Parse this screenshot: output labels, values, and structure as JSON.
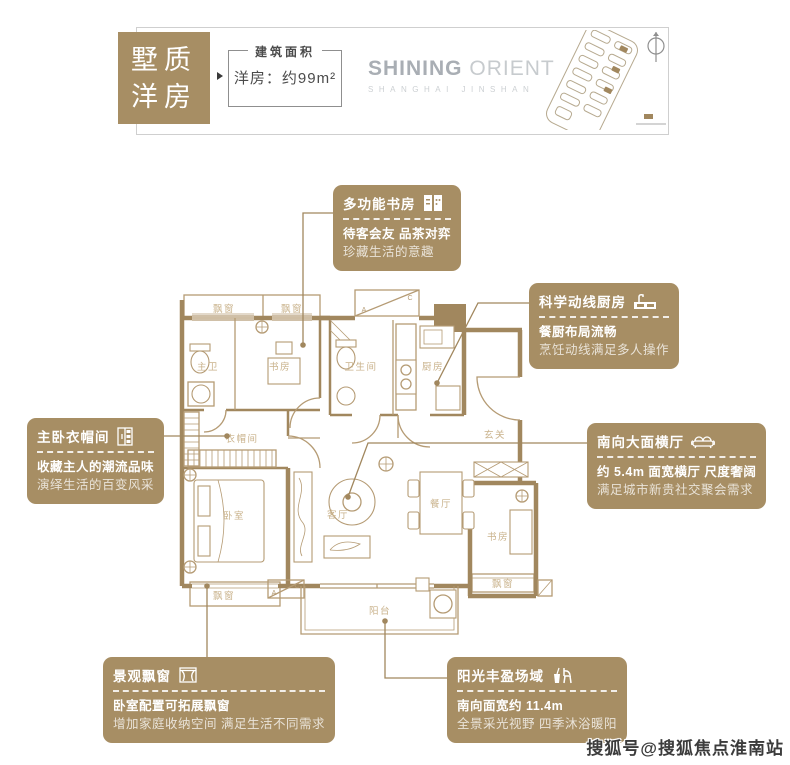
{
  "header": {
    "badge": {
      "line1": "墅质",
      "line2": "洋房"
    },
    "area_box": {
      "label": "建筑面积",
      "value": "洋房：约99m²"
    },
    "logo": {
      "title_bold": "SHINING",
      "title_light": "ORIENT",
      "subtitle": "SHANGHAI JINSHAN"
    }
  },
  "callouts": [
    {
      "title": "多功能书房",
      "icon": "bookshelf-icon",
      "line1": "待客会友 品茶对弈",
      "line2": "珍藏生活的意趣"
    },
    {
      "title": "科学动线厨房",
      "icon": "kitchen-sink-icon",
      "line1": "餐厨布局流畅",
      "line2": "烹饪动线满足多人操作"
    },
    {
      "title": "主卧衣帽间",
      "icon": "wardrobe-icon",
      "line1": "收藏主人的潮流品味",
      "line2": "演绎生活的百变风采"
    },
    {
      "title": "南向大面横厅",
      "icon": "sofa-icon",
      "line1": "约 5.4m 面宽横厅 尺度奢阔",
      "line2": "满足城市新贵社交聚会需求"
    },
    {
      "title": "景观飘窗",
      "icon": "bay-window-icon",
      "line1": "卧室配置可拓展飘窗",
      "line2": "增加家庭收纳空间 满足生活不同需求"
    },
    {
      "title": "阳光丰盈场域",
      "icon": "sun-terrace-icon",
      "line1": "南向面宽约 11.4m",
      "line2": "全景采光视野 四季沐浴暖阳"
    }
  ],
  "floorplan": {
    "rooms": [
      {
        "label": "飘窗",
        "x": 56,
        "y": 34
      },
      {
        "label": "飘窗",
        "x": 124,
        "y": 34
      },
      {
        "label": "主卫",
        "x": 40,
        "y": 92
      },
      {
        "label": "书房",
        "x": 112,
        "y": 92
      },
      {
        "label": "卫生间",
        "x": 193,
        "y": 92
      },
      {
        "label": "厨房",
        "x": 265,
        "y": 92
      },
      {
        "label": "衣帽间",
        "x": 74,
        "y": 164
      },
      {
        "label": "玄关",
        "x": 327,
        "y": 160
      },
      {
        "label": "卧室",
        "x": 66,
        "y": 241
      },
      {
        "label": "客厅",
        "x": 170,
        "y": 240
      },
      {
        "label": "餐厅",
        "x": 273,
        "y": 229
      },
      {
        "label": "书房",
        "x": 330,
        "y": 262
      },
      {
        "label": "飘窗",
        "x": 56,
        "y": 321
      },
      {
        "label": "飘窗",
        "x": 335,
        "y": 309
      },
      {
        "label": "阳台",
        "x": 212,
        "y": 336
      }
    ],
    "ac_labels": {
      "a": "A",
      "c": "C"
    }
  },
  "watermark": "搜狐号@搜狐焦点淮南站",
  "colors": {
    "gold": "#a78e64",
    "wall": "#a1875e",
    "line": "#b59b74",
    "room_label": "#c9b28b"
  }
}
